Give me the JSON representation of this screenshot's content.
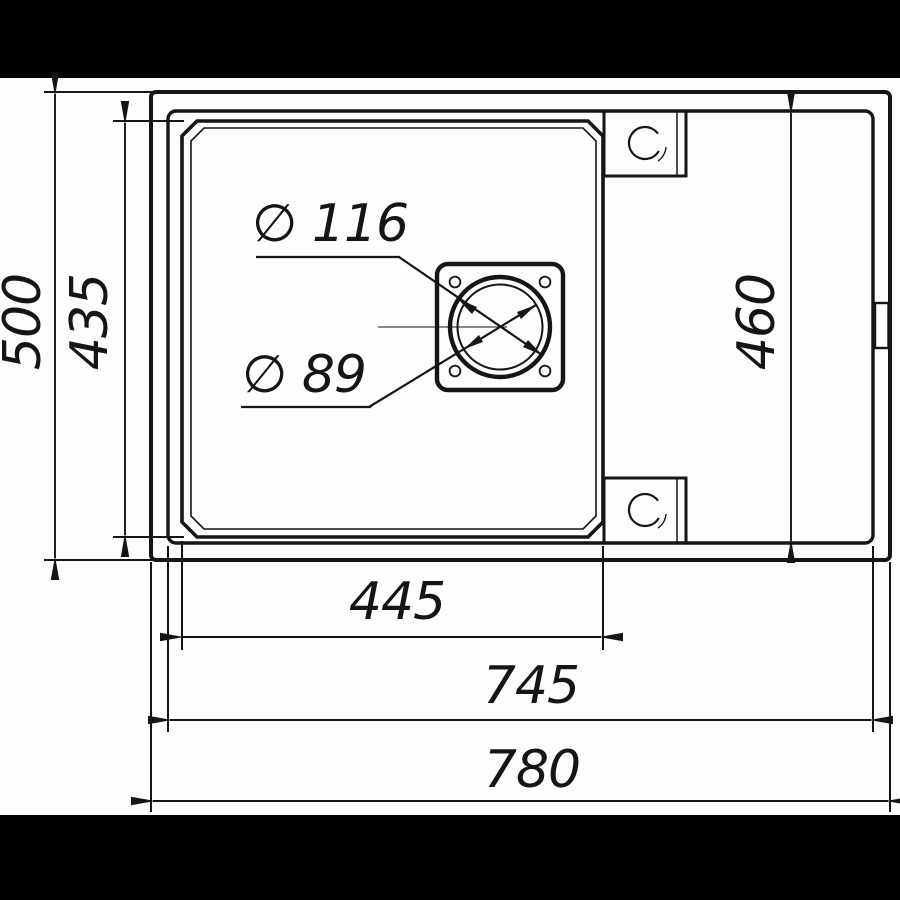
{
  "colors": {
    "background": "#fdfdfd",
    "line": "#151515",
    "letterbox": "#000000"
  },
  "drawing": {
    "dimensions": {
      "overall_width": "780",
      "rim_width": "745",
      "bowl_width": "445",
      "overall_depth": "500",
      "bowl_depth": "435",
      "rim_depth": "460",
      "drain_outer_diameter": "∅ 116",
      "drain_inner_diameter": "∅ 89"
    }
  }
}
